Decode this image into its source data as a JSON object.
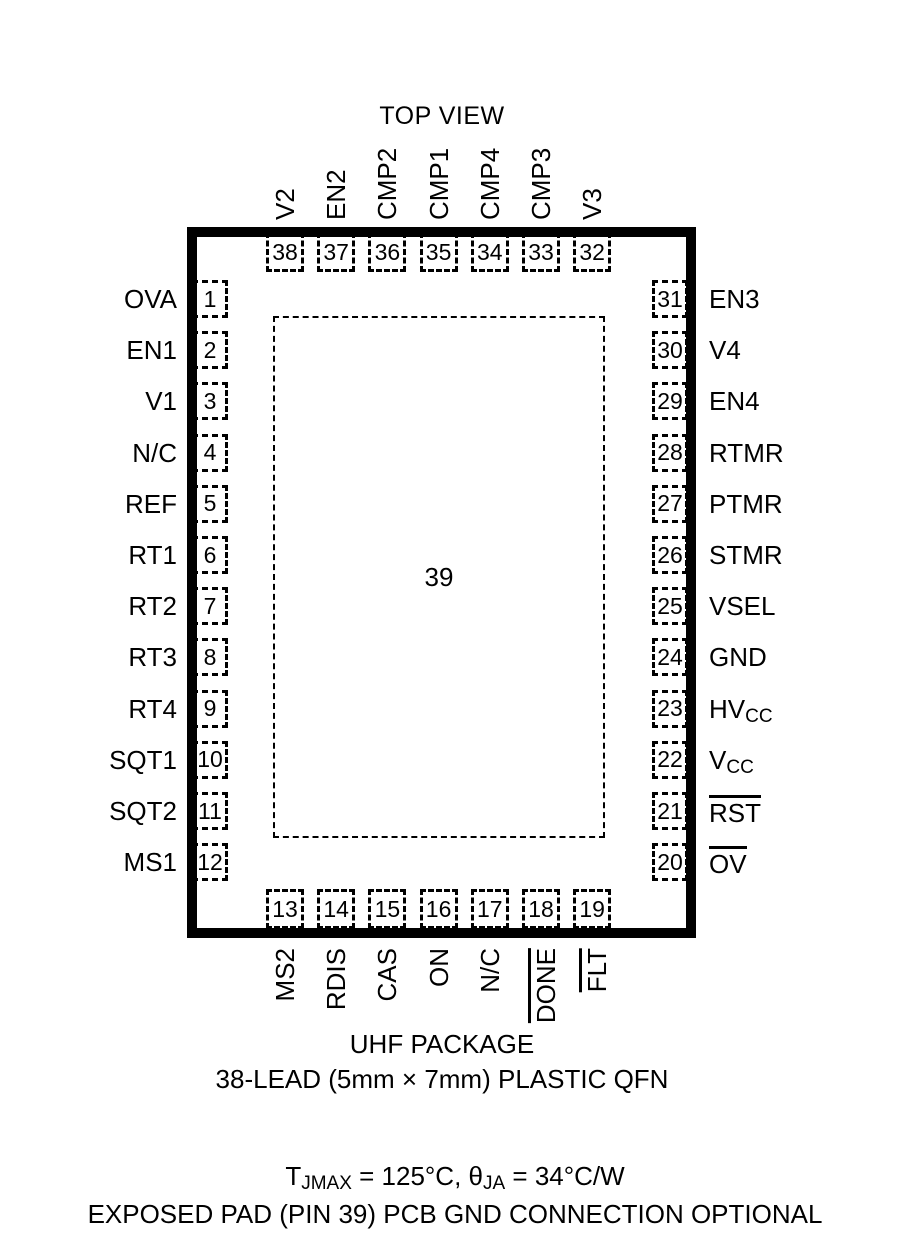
{
  "title": "TOP VIEW",
  "package": {
    "center_pin": "39",
    "caption_line1": "UHF PACKAGE",
    "caption_line2": "38-LEAD (5mm × 7mm) PLASTIC QFN"
  },
  "pins": {
    "left": [
      {
        "num": "1",
        "label": "OVA"
      },
      {
        "num": "2",
        "label": "EN1"
      },
      {
        "num": "3",
        "label": "V1"
      },
      {
        "num": "4",
        "label": "N/C"
      },
      {
        "num": "5",
        "label": "REF"
      },
      {
        "num": "6",
        "label": "RT1"
      },
      {
        "num": "7",
        "label": "RT2"
      },
      {
        "num": "8",
        "label": "RT3"
      },
      {
        "num": "9",
        "label": "RT4"
      },
      {
        "num": "10",
        "label": "SQT1"
      },
      {
        "num": "11",
        "label": "SQT2"
      },
      {
        "num": "12",
        "label": "MS1"
      }
    ],
    "right": [
      {
        "num": "31",
        "label": "EN3"
      },
      {
        "num": "30",
        "label": "V4"
      },
      {
        "num": "29",
        "label": "EN4"
      },
      {
        "num": "28",
        "label": "RTMR"
      },
      {
        "num": "27",
        "label": "PTMR"
      },
      {
        "num": "26",
        "label": "STMR"
      },
      {
        "num": "25",
        "label": "VSEL"
      },
      {
        "num": "24",
        "label": "GND"
      },
      {
        "num": "23",
        "label": "HV",
        "sub": "CC"
      },
      {
        "num": "22",
        "label": "V",
        "sub": "CC"
      },
      {
        "num": "21",
        "label": "RST",
        "overline": true
      },
      {
        "num": "20",
        "label": "OV",
        "overline": true
      }
    ],
    "top": [
      {
        "num": "38",
        "label": "V2"
      },
      {
        "num": "37",
        "label": "EN2"
      },
      {
        "num": "36",
        "label": "CMP2"
      },
      {
        "num": "35",
        "label": "CMP1"
      },
      {
        "num": "34",
        "label": "CMP4"
      },
      {
        "num": "33",
        "label": "CMP3"
      },
      {
        "num": "32",
        "label": "V3"
      }
    ],
    "bottom": [
      {
        "num": "13",
        "label": "MS2"
      },
      {
        "num": "14",
        "label": "RDIS"
      },
      {
        "num": "15",
        "label": "CAS"
      },
      {
        "num": "16",
        "label": "ON"
      },
      {
        "num": "17",
        "label": "N/C"
      },
      {
        "num": "18",
        "label": "DONE",
        "overline": true
      },
      {
        "num": "19",
        "label": "FLT",
        "overline": true
      }
    ]
  },
  "footer": {
    "line1_segments": [
      {
        "text": "T"
      },
      {
        "text": "JMAX",
        "sub": true
      },
      {
        "text": " = 125°C, "
      },
      {
        "text": "θ"
      },
      {
        "text": "JA",
        "sub": true
      },
      {
        "text": " = 34°C/W"
      }
    ],
    "line2": "EXPOSED PAD (PIN 39) PCB GND CONNECTION OPTIONAL"
  },
  "colors": {
    "ink": "#000000",
    "background": "#ffffff"
  }
}
